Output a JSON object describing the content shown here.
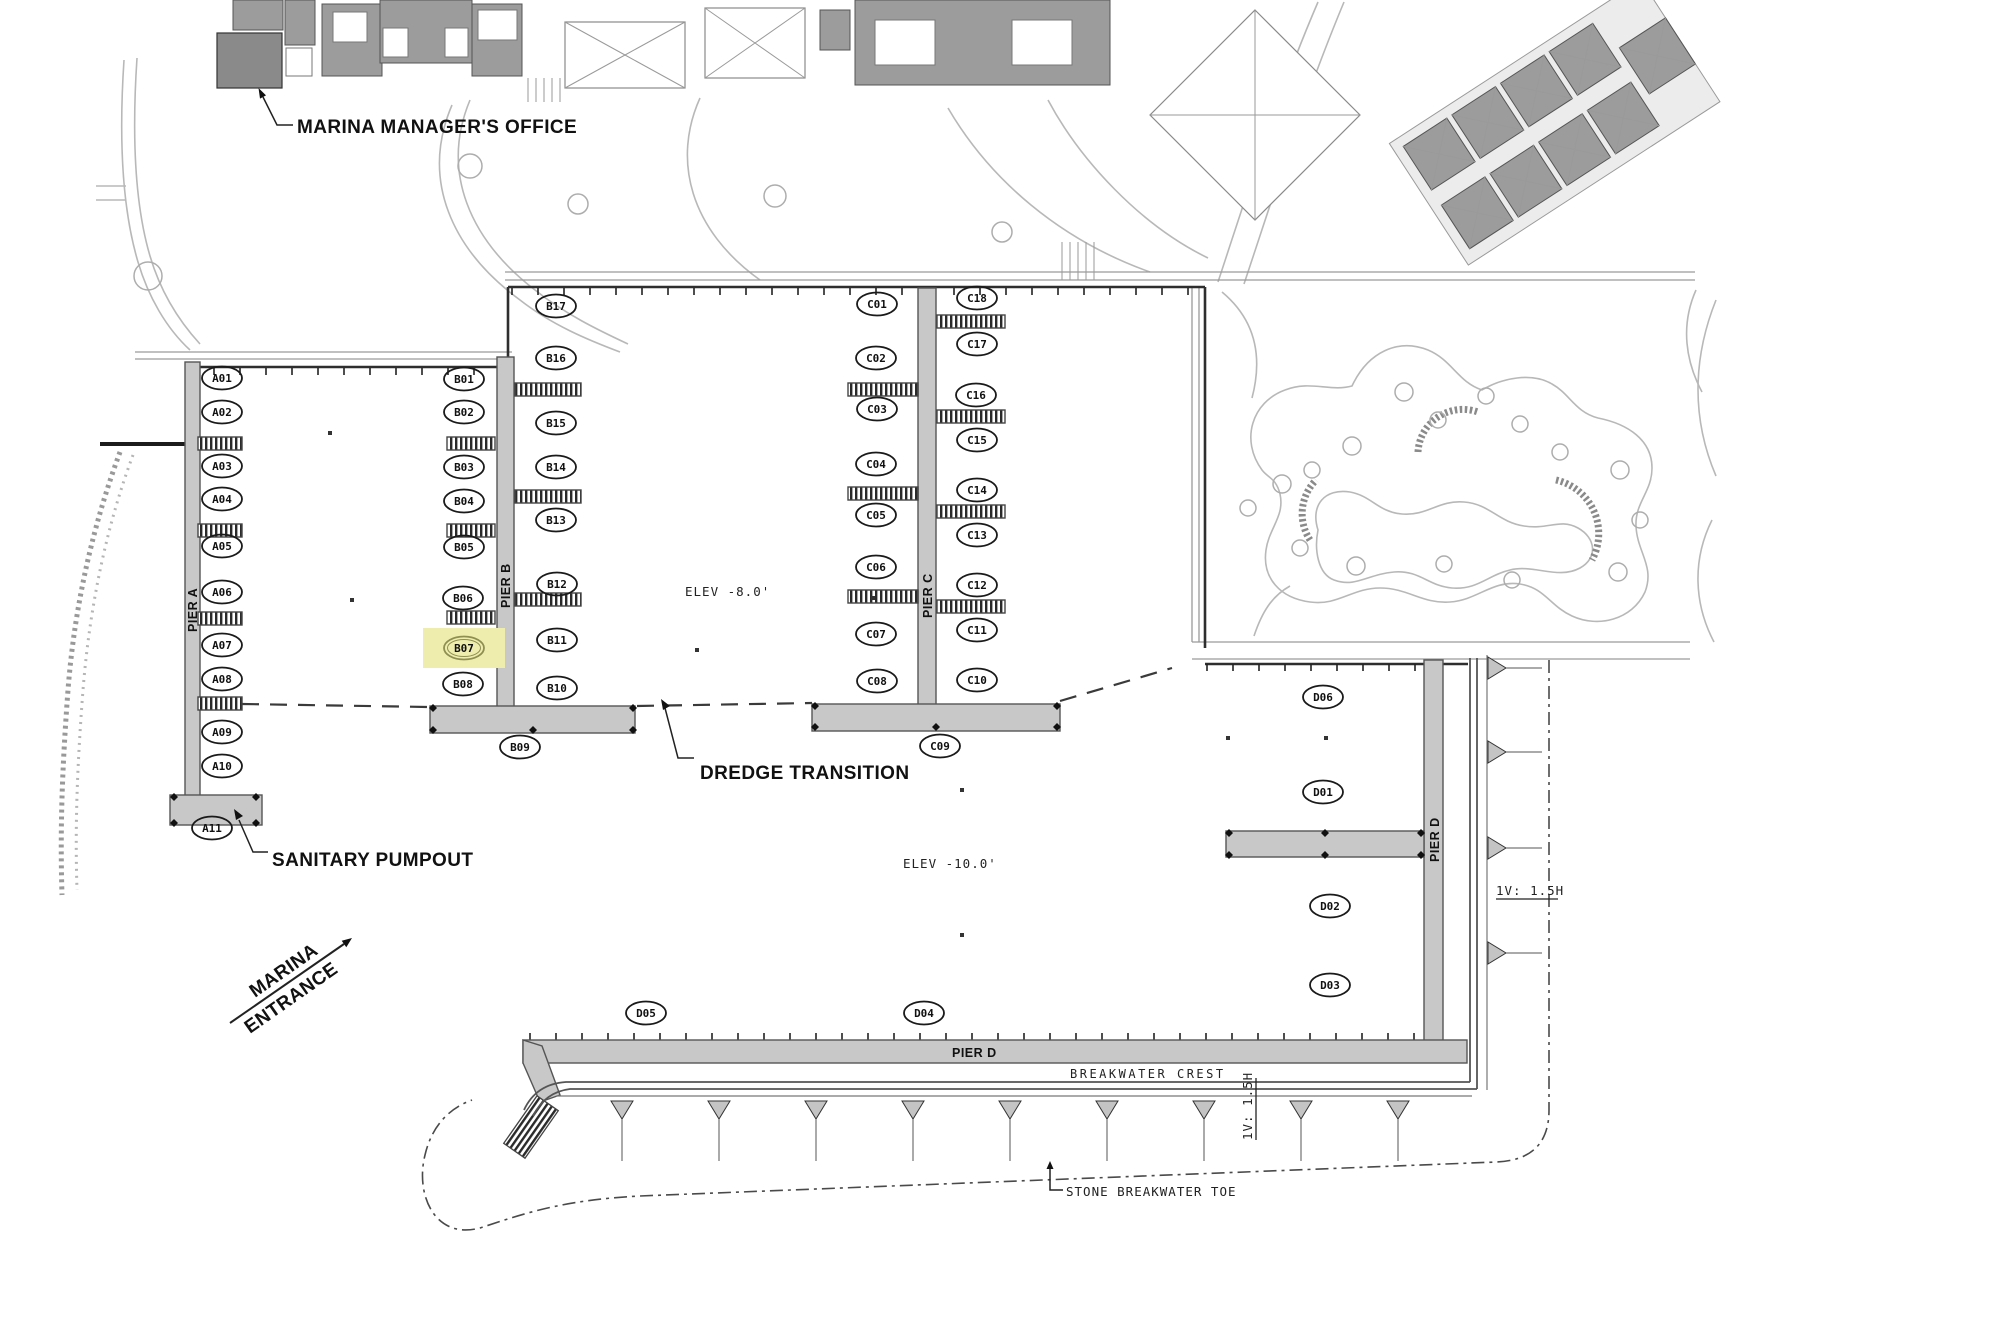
{
  "annotations": {
    "marina_managers_office": "MARINA MANAGER'S OFFICE",
    "sanitary_pumpout": "SANITARY PUMPOUT",
    "dredge_transition": "DREDGE TRANSITION",
    "marina_entrance_line1": "MARINA",
    "marina_entrance_line2": "ENTRANCE",
    "elev_upper_basin": "ELEV -8.0'",
    "elev_lower_basin": "ELEV -10.0'",
    "breakwater_crest": "BREAKWATER CREST",
    "stone_breakwater_toe": "STONE BREAKWATER TOE",
    "slope_ratio_bottom": "1V: 1.5H",
    "slope_ratio_right": "1V: 1.5H"
  },
  "highlight": {
    "slip": "B07",
    "color": "#efedae",
    "stroke": "#8f8f52",
    "text_color": "#7e7e49"
  },
  "piers": [
    {
      "id": "pier-a",
      "label": "PIER A",
      "slips": [
        {
          "id": "A01",
          "x": 222,
          "y": 378
        },
        {
          "id": "A02",
          "x": 222,
          "y": 412
        },
        {
          "id": "A03",
          "x": 222,
          "y": 466
        },
        {
          "id": "A04",
          "x": 222,
          "y": 499
        },
        {
          "id": "A05",
          "x": 222,
          "y": 546
        },
        {
          "id": "A06",
          "x": 222,
          "y": 592
        },
        {
          "id": "A07",
          "x": 222,
          "y": 645
        },
        {
          "id": "A08",
          "x": 222,
          "y": 679
        },
        {
          "id": "A09",
          "x": 222,
          "y": 732
        },
        {
          "id": "A10",
          "x": 222,
          "y": 766
        },
        {
          "id": "A11",
          "x": 212,
          "y": 828
        }
      ]
    },
    {
      "id": "pier-b",
      "label": "PIER B",
      "slips": [
        {
          "id": "B01",
          "x": 464,
          "y": 379
        },
        {
          "id": "B02",
          "x": 464,
          "y": 412
        },
        {
          "id": "B03",
          "x": 464,
          "y": 467
        },
        {
          "id": "B04",
          "x": 464,
          "y": 501
        },
        {
          "id": "B05",
          "x": 464,
          "y": 547
        },
        {
          "id": "B06",
          "x": 463,
          "y": 598
        },
        {
          "id": "B07",
          "x": 464,
          "y": 648
        },
        {
          "id": "B08",
          "x": 463,
          "y": 684
        },
        {
          "id": "B09",
          "x": 520,
          "y": 747
        },
        {
          "id": "B10",
          "x": 557,
          "y": 688
        },
        {
          "id": "B11",
          "x": 557,
          "y": 640
        },
        {
          "id": "B12",
          "x": 557,
          "y": 584
        },
        {
          "id": "B13",
          "x": 556,
          "y": 520
        },
        {
          "id": "B14",
          "x": 556,
          "y": 467
        },
        {
          "id": "B15",
          "x": 556,
          "y": 423
        },
        {
          "id": "B16",
          "x": 556,
          "y": 358
        },
        {
          "id": "B17",
          "x": 556,
          "y": 306
        }
      ]
    },
    {
      "id": "pier-c",
      "label": "PIER C",
      "slips": [
        {
          "id": "C01",
          "x": 877,
          "y": 304
        },
        {
          "id": "C02",
          "x": 876,
          "y": 358
        },
        {
          "id": "C03",
          "x": 877,
          "y": 409
        },
        {
          "id": "C04",
          "x": 876,
          "y": 464
        },
        {
          "id": "C05",
          "x": 876,
          "y": 515
        },
        {
          "id": "C06",
          "x": 876,
          "y": 567
        },
        {
          "id": "C07",
          "x": 876,
          "y": 634
        },
        {
          "id": "C08",
          "x": 877,
          "y": 681
        },
        {
          "id": "C09",
          "x": 940,
          "y": 746
        },
        {
          "id": "C10",
          "x": 977,
          "y": 680
        },
        {
          "id": "C11",
          "x": 977,
          "y": 630
        },
        {
          "id": "C12",
          "x": 977,
          "y": 585
        },
        {
          "id": "C13",
          "x": 977,
          "y": 535
        },
        {
          "id": "C14",
          "x": 977,
          "y": 490
        },
        {
          "id": "C15",
          "x": 977,
          "y": 440
        },
        {
          "id": "C16",
          "x": 976,
          "y": 395
        },
        {
          "id": "C17",
          "x": 977,
          "y": 344
        },
        {
          "id": "C18",
          "x": 977,
          "y": 298
        }
      ]
    },
    {
      "id": "pier-d",
      "label": "PIER D",
      "slips": [
        {
          "id": "D01",
          "x": 1323,
          "y": 792
        },
        {
          "id": "D02",
          "x": 1330,
          "y": 906
        },
        {
          "id": "D03",
          "x": 1330,
          "y": 985
        },
        {
          "id": "D04",
          "x": 924,
          "y": 1013
        },
        {
          "id": "D05",
          "x": 646,
          "y": 1013
        },
        {
          "id": "D06",
          "x": 1323,
          "y": 697
        }
      ]
    }
  ]
}
